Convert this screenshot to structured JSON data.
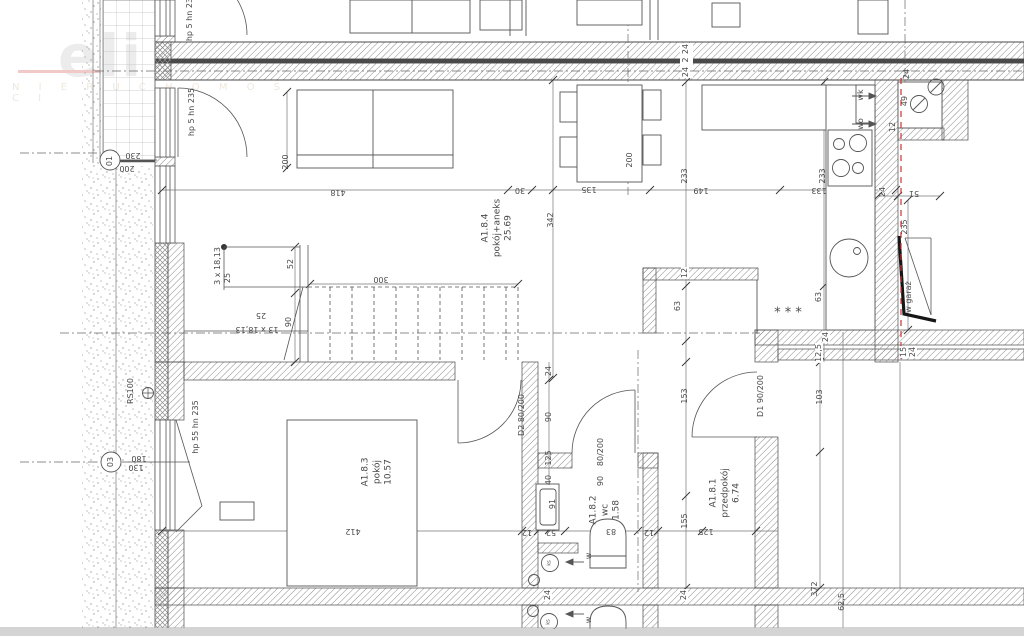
{
  "watermark": {
    "logo": "eli",
    "sub": "N I E R U C H O M O Ś C I"
  },
  "colors": {
    "line": "#555555",
    "wall_fill_dark": "#4a4a4a",
    "red_dashed": "#cc3333",
    "hatch": "#8c8c8c",
    "stipple": "#9a9a9a",
    "grid": "#c0c0c0",
    "bottom_bar": "#d4d4d4"
  },
  "rooms": [
    {
      "id": "A1.8.4",
      "name": "pokój+aneks",
      "area": "25.69",
      "x": 498,
      "y": 228
    },
    {
      "id": "A1.8.3",
      "name": "pokój",
      "area": "10.57",
      "x": 378,
      "y": 472
    },
    {
      "id": "A1.8.2",
      "name": "wc",
      "area": "1.58",
      "x": 606,
      "y": 510
    },
    {
      "id": "A1.8.1",
      "name": "przedpokój",
      "area": "6.74",
      "x": 726,
      "y": 493
    }
  ],
  "labels": [
    {
      "t": "hp 5 hn 235",
      "x": 190,
      "y": 17,
      "r": -90
    },
    {
      "t": "hp 5 hn 235",
      "x": 192,
      "y": 112,
      "r": -90
    },
    {
      "t": "hp 55 hn 235",
      "x": 196,
      "y": 427,
      "r": -90
    },
    {
      "t": "RS100",
      "x": 131,
      "y": 391,
      "r": -90
    },
    {
      "t": "01",
      "x": 110,
      "y": 161,
      "r": -90
    },
    {
      "t": "03",
      "x": 111,
      "y": 462,
      "r": -90
    },
    {
      "t": "342",
      "x": 551,
      "y": 220,
      "r": -90
    },
    {
      "t": "200",
      "x": 286,
      "y": 162,
      "r": -90
    },
    {
      "t": "200",
      "x": 630,
      "y": 160,
      "r": -90
    },
    {
      "t": "233",
      "x": 685,
      "y": 176,
      "r": -90
    },
    {
      "t": "233",
      "x": 823,
      "y": 176,
      "r": -90
    },
    {
      "t": "3 x 18,13",
      "x": 218,
      "y": 266,
      "r": -90
    },
    {
      "t": "25",
      "x": 228,
      "y": 278,
      "r": -90
    },
    {
      "t": "52",
      "x": 291,
      "y": 264,
      "r": -90
    },
    {
      "t": "90",
      "x": 289,
      "y": 322,
      "r": -90
    },
    {
      "t": "24",
      "x": 686,
      "y": 49,
      "r": -90,
      "b": true
    },
    {
      "t": "2",
      "x": 686,
      "y": 60,
      "r": -90,
      "b": true
    },
    {
      "t": "24",
      "x": 686,
      "y": 72,
      "r": -90,
      "b": true
    },
    {
      "t": "wk",
      "x": 861,
      "y": 95,
      "r": -90
    },
    {
      "t": "wo",
      "x": 861,
      "y": 124,
      "r": -90
    },
    {
      "t": "24",
      "x": 907,
      "y": 74,
      "r": -90
    },
    {
      "t": "49",
      "x": 905,
      "y": 101,
      "r": -90
    },
    {
      "t": "12",
      "x": 893,
      "y": 127,
      "r": -90
    },
    {
      "t": "24",
      "x": 883,
      "y": 192,
      "r": -90
    },
    {
      "t": "235",
      "x": 905,
      "y": 227,
      "r": -90
    },
    {
      "t": "w garaż",
      "x": 909,
      "y": 297,
      "r": -90
    },
    {
      "t": "12",
      "x": 685,
      "y": 273,
      "r": -90,
      "b": true
    },
    {
      "t": "63",
      "x": 678,
      "y": 306,
      "r": -90
    },
    {
      "t": "63",
      "x": 819,
      "y": 297,
      "r": -90
    },
    {
      "t": "24",
      "x": 826,
      "y": 337,
      "r": -90,
      "b": true
    },
    {
      "t": "12,5",
      "x": 819,
      "y": 353,
      "r": -90,
      "b": true
    },
    {
      "t": "15",
      "x": 904,
      "y": 352,
      "r": -90,
      "b": true
    },
    {
      "t": "24",
      "x": 913,
      "y": 352,
      "r": -90,
      "b": true
    },
    {
      "t": "153",
      "x": 685,
      "y": 396,
      "r": -90
    },
    {
      "t": "D1 90/200",
      "x": 761,
      "y": 396,
      "r": -90
    },
    {
      "t": "103",
      "x": 820,
      "y": 397,
      "r": -90
    },
    {
      "t": "24",
      "x": 549,
      "y": 371,
      "r": -90
    },
    {
      "t": "90",
      "x": 549,
      "y": 417,
      "r": -90
    },
    {
      "t": "125",
      "x": 549,
      "y": 458,
      "r": -90
    },
    {
      "t": "40",
      "x": 549,
      "y": 480,
      "r": -90
    },
    {
      "t": "91",
      "x": 553,
      "y": 504,
      "r": -90
    },
    {
      "t": "D2 80/200",
      "x": 522,
      "y": 415,
      "r": -90
    },
    {
      "t": "80/200",
      "x": 601,
      "y": 452,
      "r": -90
    },
    {
      "t": "90",
      "x": 601,
      "y": 481,
      "r": -90
    },
    {
      "t": "155",
      "x": 685,
      "y": 521,
      "r": -90
    },
    {
      "t": "24",
      "x": 548,
      "y": 595,
      "r": -90,
      "b": true
    },
    {
      "t": "24",
      "x": 684,
      "y": 595,
      "r": -90,
      "b": true
    },
    {
      "t": "372",
      "x": 815,
      "y": 589,
      "r": -90
    },
    {
      "t": "62,5",
      "x": 842,
      "y": 602,
      "r": -90
    },
    {
      "t": "w",
      "x": 589,
      "y": 556,
      "r": -90
    },
    {
      "t": "w",
      "x": 589,
      "y": 620,
      "r": -90
    },
    {
      "t": "ks",
      "x": 550,
      "y": 563,
      "r": -90,
      "s": 5
    },
    {
      "t": "ks",
      "x": 549,
      "y": 622,
      "r": -90,
      "s": 5
    },
    {
      "t": "230",
      "x": 133,
      "y": 155,
      "r": 180
    },
    {
      "t": "200",
      "x": 127,
      "y": 168,
      "r": 180
    },
    {
      "t": "180",
      "x": 139,
      "y": 458,
      "r": 180
    },
    {
      "t": "130",
      "x": 136,
      "y": 467,
      "r": 180
    },
    {
      "t": "418",
      "x": 338,
      "y": 192,
      "r": 180
    },
    {
      "t": "30",
      "x": 520,
      "y": 190,
      "r": 180
    },
    {
      "t": "135",
      "x": 589,
      "y": 189,
      "r": 180
    },
    {
      "t": "149",
      "x": 701,
      "y": 190,
      "r": 180
    },
    {
      "t": "133",
      "x": 819,
      "y": 190,
      "r": 180
    },
    {
      "t": "51",
      "x": 914,
      "y": 193,
      "r": 180
    },
    {
      "t": "300",
      "x": 381,
      "y": 279,
      "r": 180
    },
    {
      "t": "25",
      "x": 261,
      "y": 315,
      "r": 180
    },
    {
      "t": "13 x 18,13",
      "x": 257,
      "y": 329,
      "r": 180
    },
    {
      "t": "412",
      "x": 353,
      "y": 531,
      "r": 180
    },
    {
      "t": "12",
      "x": 527,
      "y": 532,
      "r": 180
    },
    {
      "t": "52",
      "x": 551,
      "y": 532,
      "r": 180
    },
    {
      "t": "83",
      "x": 611,
      "y": 531,
      "r": 180
    },
    {
      "t": "12",
      "x": 649,
      "y": 532,
      "r": 180
    },
    {
      "t": "125",
      "x": 706,
      "y": 531,
      "r": 180
    },
    {
      "t": "* * *",
      "x": 788,
      "y": 313,
      "r": 0,
      "s": 13
    }
  ]
}
